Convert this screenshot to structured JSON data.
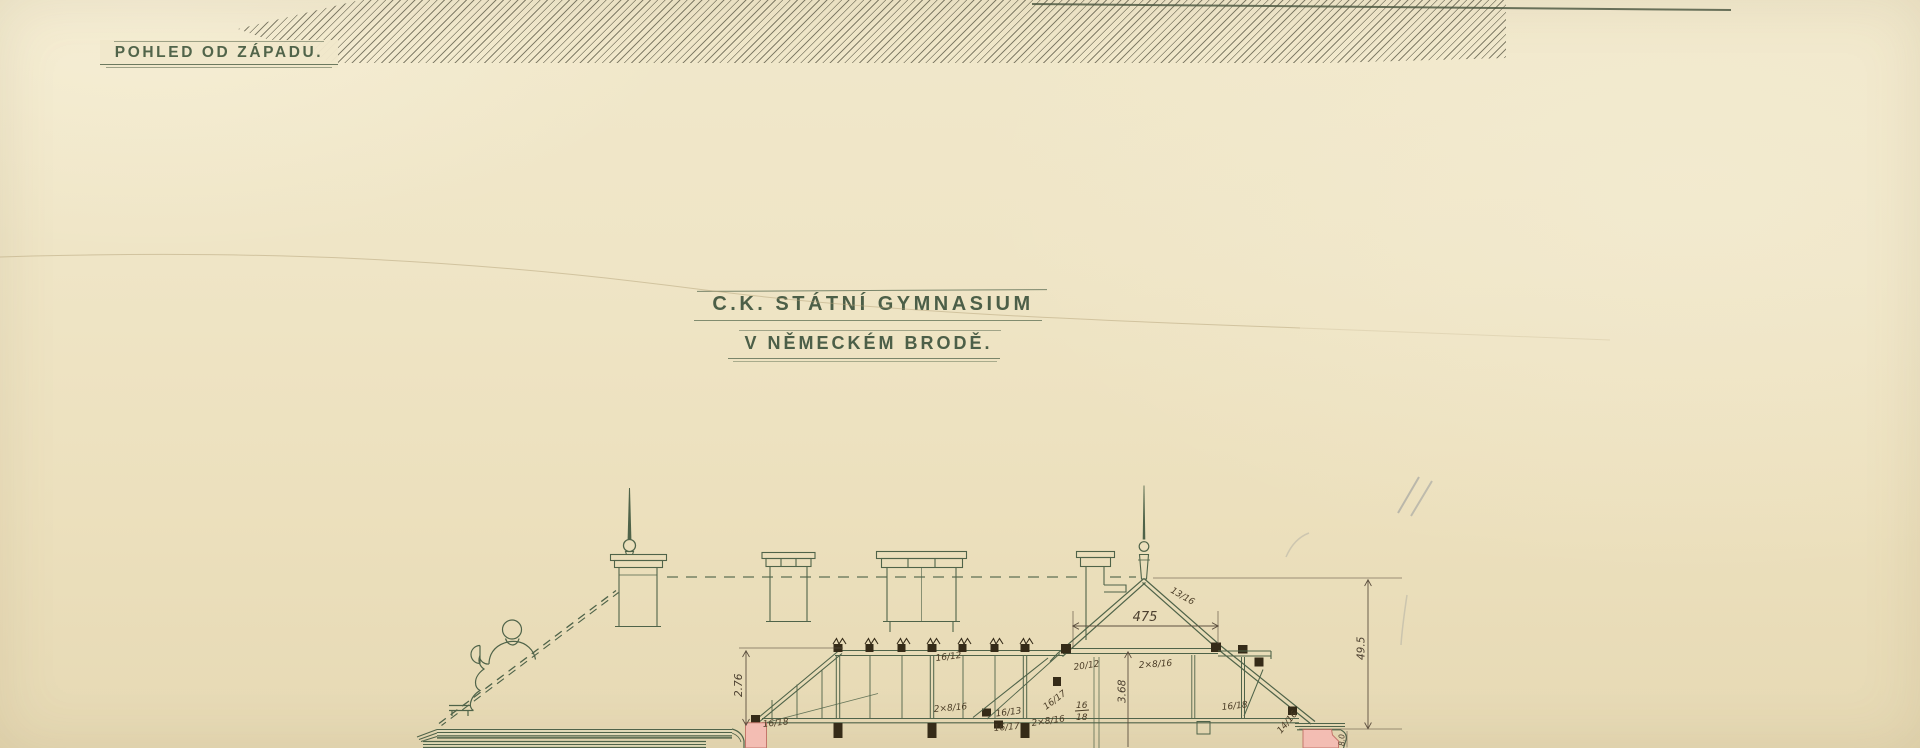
{
  "sheet": {
    "view_label": "POHLED OD ZÁPADU.",
    "title": {
      "line1": "C.K. STÁTNÍ GYMNASIUM",
      "line2": "V NĚMECKÉM BRODĚ."
    }
  },
  "section": {
    "dims": {
      "span": "475",
      "left_truss_height": "2.76",
      "attic_height": "3.68",
      "ridge_height": "49.5",
      "cornice_height": "8.0"
    },
    "marks": [
      {
        "text": "16/18"
      },
      {
        "text": "16/12"
      },
      {
        "text": "2×8/16"
      },
      {
        "text": "16/13"
      },
      {
        "text": "16/17"
      },
      {
        "text": "2×8/16"
      },
      {
        "text": "20/12"
      },
      {
        "text": "16/17"
      },
      {
        "text": "16"
      },
      {
        "text": "18"
      },
      {
        "text": "2×8/16"
      },
      {
        "text": "13/16"
      },
      {
        "text": "16/18"
      },
      {
        "text": "14/16"
      }
    ]
  },
  "colors": {
    "paper": "#efe5c6",
    "ink": "#4f6349",
    "annotation": "#4a3c26",
    "masonry_pink": "#f3bdb3",
    "pencil_hatch": "#50503c",
    "timber_block": "#352b18"
  }
}
